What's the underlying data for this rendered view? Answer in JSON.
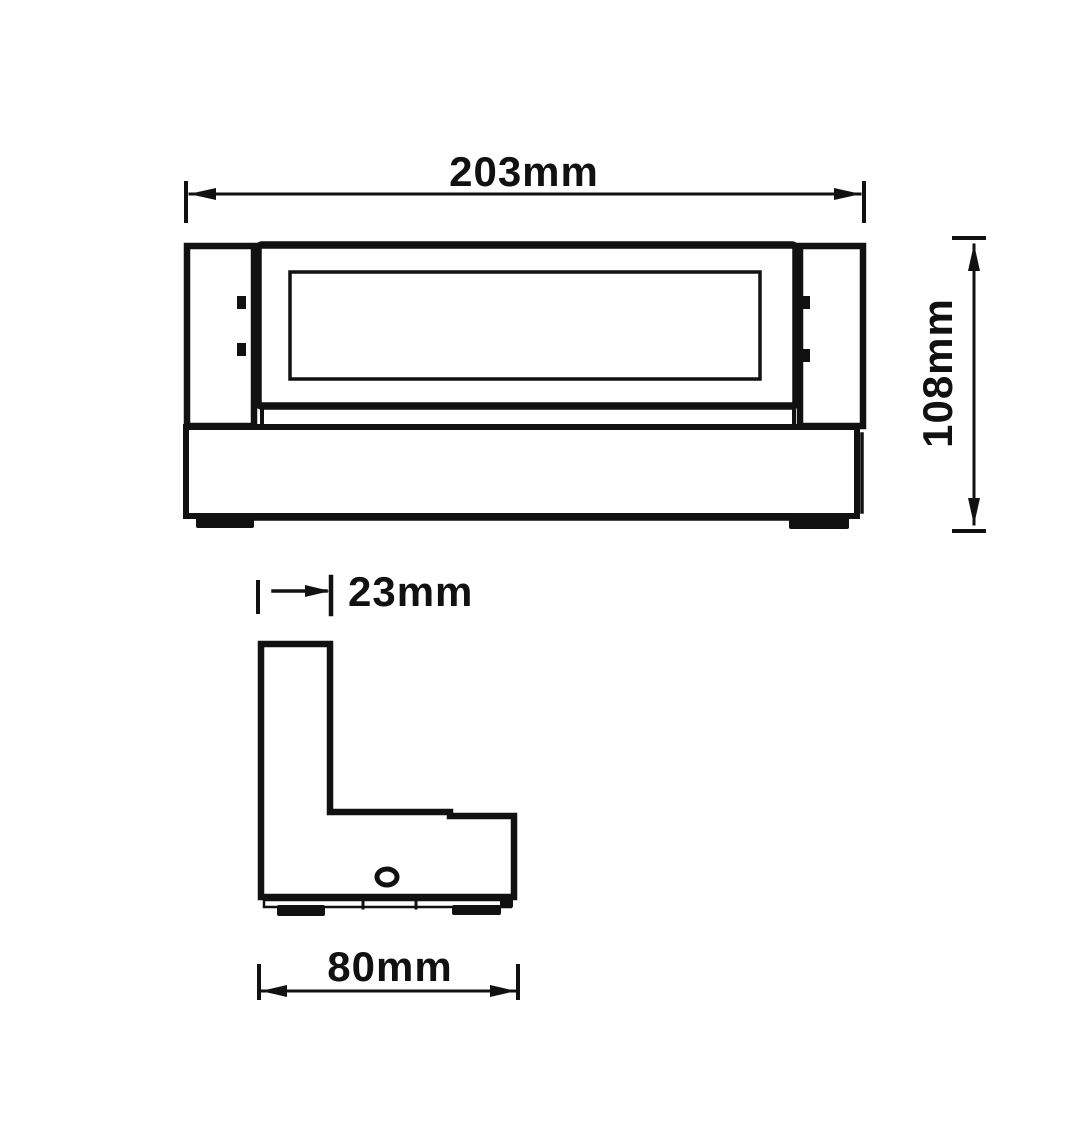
{
  "colors": {
    "line": "#111111",
    "background": "#ffffff"
  },
  "front_view": {
    "width_dimension_label": "203mm",
    "height_dimension_label": "108mm"
  },
  "side_view": {
    "depth_top_dimension_label": "23mm",
    "depth_bottom_dimension_label": "80mm"
  }
}
